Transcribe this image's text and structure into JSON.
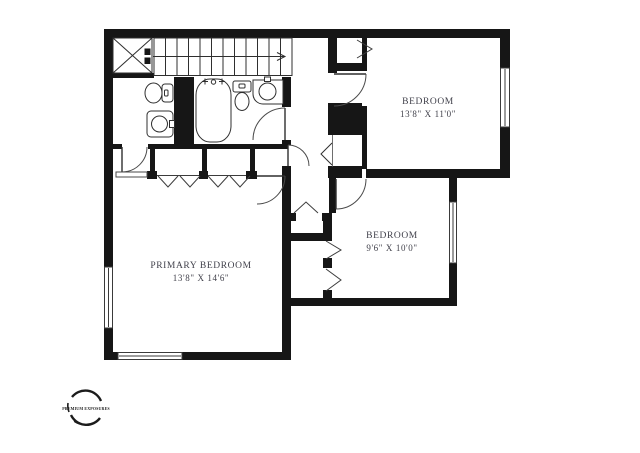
{
  "floor_plan": {
    "rooms": [
      {
        "id": "bedroom-top-right",
        "label": "BEDROOM",
        "dimensions": "13'8\" X 11'0\""
      },
      {
        "id": "bedroom-middle-right",
        "label": "BEDROOM",
        "dimensions": "9'6\" X 10'0\""
      },
      {
        "id": "primary-bedroom",
        "label": "PRIMARY BEDROOM",
        "dimensions": "13'8\" X 14'6\""
      }
    ],
    "fixtures": [
      "stairs-up-arrow",
      "x-box-closet",
      "toilet-fixture",
      "corner-sink-fixture",
      "bathtub-fixture",
      "toilet-fixture-2",
      "vanity-sink-fixture",
      "window",
      "hinged-door",
      "bifold-closet-door"
    ],
    "watermark": {
      "brand": "PREMIUM EXPOSURES"
    },
    "colors": {
      "background": "#ffffff",
      "wall": "#161616",
      "thin_line": "#333333",
      "label_text": "#41414b"
    }
  }
}
